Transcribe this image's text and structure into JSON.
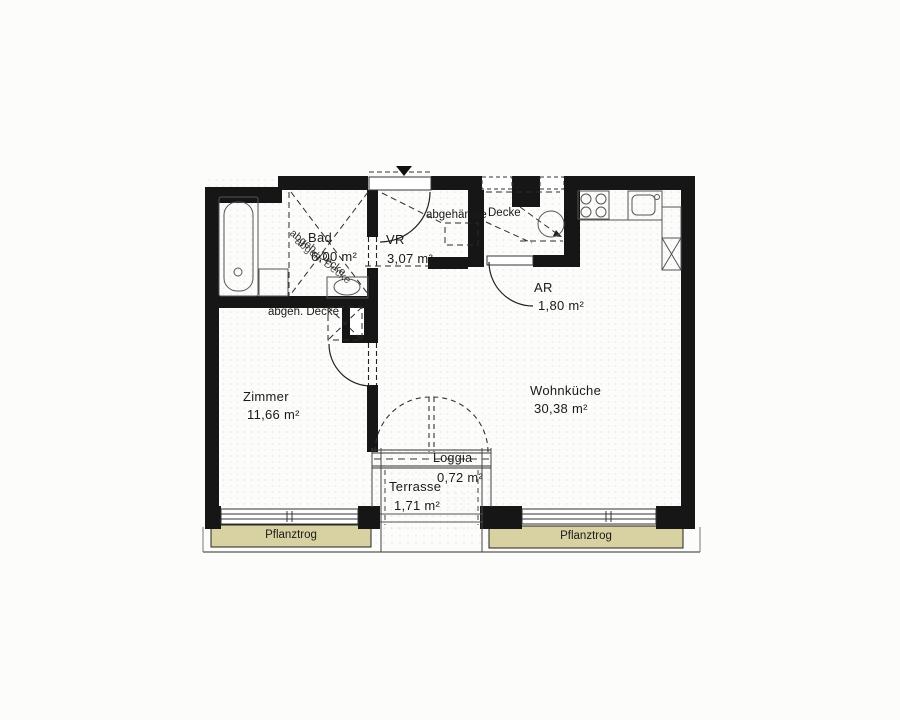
{
  "plan": {
    "type": "apartment-floor-plan",
    "rooms": {
      "bad": {
        "name": "Bad",
        "area": "6,00 m²"
      },
      "vr": {
        "name": "VR",
        "area": "3,07 m²"
      },
      "ar": {
        "name": "AR",
        "area": "1,80 m²"
      },
      "zimmer": {
        "name": "Zimmer",
        "area": "11,66 m²"
      },
      "wohnkueche": {
        "name": "Wohnküche",
        "area": "30,38 m²"
      },
      "loggia": {
        "name": "Loggia",
        "area": "0,72 m²"
      },
      "terrasse": {
        "name": "Terrasse",
        "area": "1,71 m²"
      }
    },
    "annotations": {
      "abgehaengte": "abgehängte",
      "decke": "Decke",
      "abgeh_decke": "abgeh. Decke",
      "planter": "Pflanztrog"
    },
    "colors": {
      "wall": "#161616",
      "planter_fill": "#d8d2a2",
      "line": "#3a3a3a",
      "paper": "#fcfcfb"
    }
  }
}
